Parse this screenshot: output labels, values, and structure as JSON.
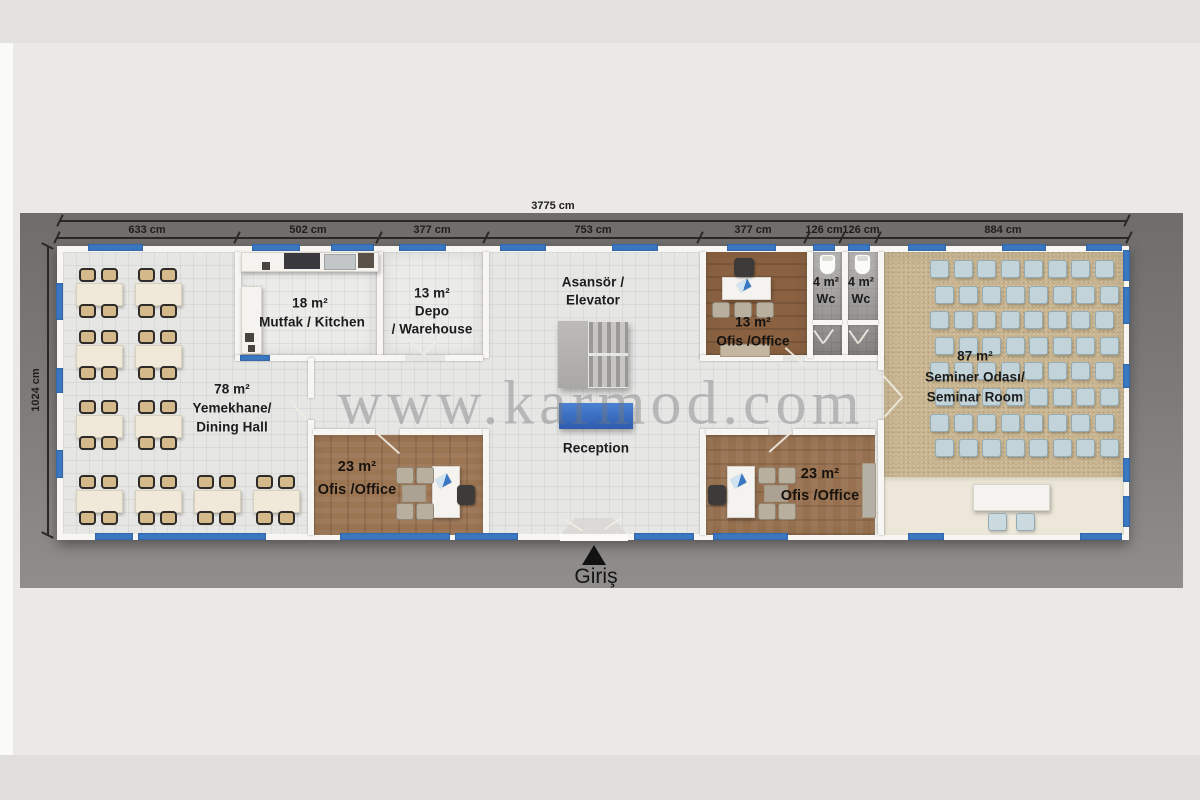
{
  "page": {
    "watermark": "www.karmod.com"
  },
  "dimensions": {
    "total": "3775 cm",
    "height": "1024 cm",
    "segments": [
      "633 cm",
      "502 cm",
      "377 cm",
      "753 cm",
      "377 cm",
      "126 cm",
      "126 cm",
      "884 cm"
    ]
  },
  "entrance": {
    "label": "Giriş"
  },
  "rooms": {
    "dining": {
      "area": "78 m²",
      "name_tr": "Yemekhane/",
      "name_en": "Dining Hall",
      "table_rows": [
        2,
        2,
        2,
        4
      ],
      "chairs_per_table": 4
    },
    "kitchen": {
      "area": "18 m²",
      "name": "Mutfak / Kitchen"
    },
    "warehouse": {
      "area": "13 m²",
      "name_line1": "Depo",
      "name_line2": "/ Warehouse"
    },
    "elevator": {
      "name_line1": "Asansör /",
      "name_line2": "Elevator"
    },
    "reception": {
      "name": "Reception"
    },
    "office13": {
      "area": "13 m²",
      "name": "Ofis /Office"
    },
    "wc_left": {
      "area": "4 m²",
      "name": "Wc"
    },
    "wc_right": {
      "area": "4 m²",
      "name": "Wc"
    },
    "seminar": {
      "area": "87 m²",
      "name_tr": "Seminer Odası/",
      "name_en": "Seminar Room",
      "chair_rows": 8,
      "chairs_per_row": 8
    },
    "office23_left": {
      "area": "23 m²",
      "name": "Ofis /Office"
    },
    "office23_right": {
      "area": "23 m²",
      "name": "Ofis /Office"
    }
  },
  "colors": {
    "window_blue": "#3b78c3",
    "reception_desk_blue": "#3668bf",
    "mat_gray": "#7e7c7a",
    "carpet_tan": "#c8b48f",
    "wood_brown": "#96704e",
    "wall_white": "#f7f6f3"
  }
}
